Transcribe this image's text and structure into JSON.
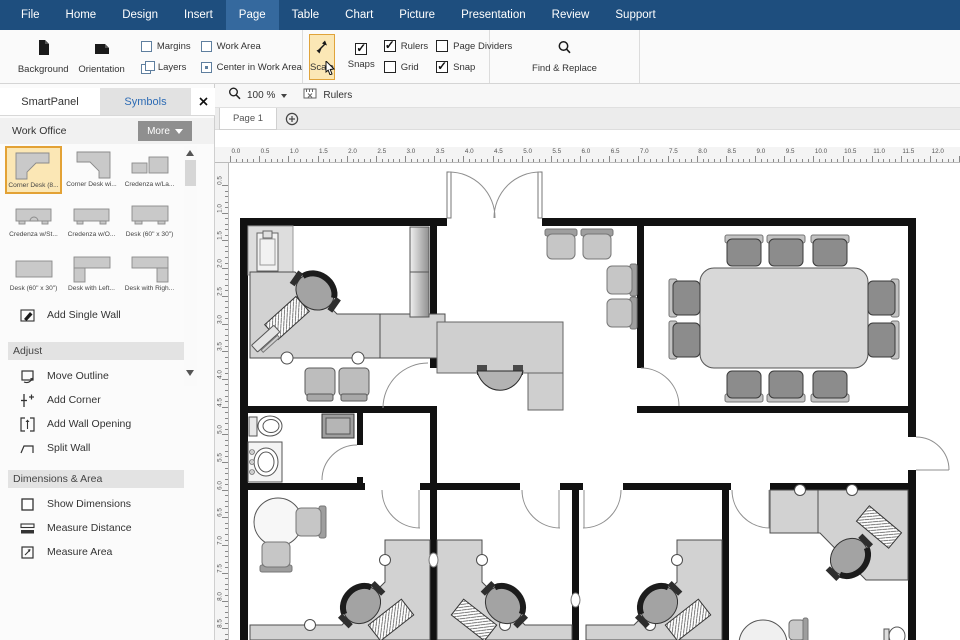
{
  "menu": {
    "items": [
      "File",
      "Home",
      "Design",
      "Insert",
      "Page",
      "Table",
      "Chart",
      "Picture",
      "Presentation",
      "Review",
      "Support"
    ],
    "active": "Page"
  },
  "ribbon": {
    "background_label": "Background",
    "orientation_label": "Orientation",
    "margins_label": "Margins",
    "layers_label": "Layers",
    "work_area_label": "Work Area",
    "center_label": "Center in Work Area",
    "scale_label": "Scale",
    "snaps_label": "Snaps",
    "rulers_label": "Rulers",
    "grid_label": "Grid",
    "page_dividers_label": "Page Dividers",
    "snap_label": "Snap",
    "find_replace_label": "Find & Replace",
    "checks": {
      "snaps": true,
      "rulers": true,
      "grid": false,
      "page_dividers": false,
      "snap": true
    }
  },
  "panel": {
    "tabs": [
      "SmartPanel",
      "Symbols"
    ],
    "active_tab": "Symbols",
    "library": "Work Office",
    "more_label": "More",
    "symbols": [
      "Corner Desk (8...",
      "Corner Desk wi...",
      "Credenza w/La...",
      "Credenza w/St...",
      "Credenza w/O...",
      "Desk (60\" x 30\")",
      "Desk (60\" x 30\")",
      "Desk with Left...",
      "Desk with Righ..."
    ],
    "selected_symbol": "Corner Desk (8...",
    "add_single_wall": "Add Single Wall",
    "adjust": {
      "title": "Adjust",
      "items": [
        "Move Outline",
        "Add Corner",
        "Add Wall Opening",
        "Split Wall"
      ]
    },
    "dimensions": {
      "title": "Dimensions & Area",
      "items": [
        "Show Dimensions",
        "Measure Distance",
        "Measure Area"
      ]
    }
  },
  "canvas": {
    "zoom_level": "100 %",
    "rulers_label": "Rulers",
    "page_tab": "Page 1",
    "h_ruler_labels": [
      "0.0",
      "0.5",
      "1.0",
      "1.5",
      "2.0",
      "2.5",
      "3.0",
      "3.5",
      "4.0",
      "4.5",
      "5.0",
      "5.5",
      "6.0",
      "6.5",
      "7.0",
      "7.5",
      "8.0",
      "8.5",
      "9.0",
      "9.5",
      "10.0",
      "10.5",
      "11.0",
      "11.5",
      "12.0",
      "12.5"
    ],
    "v_ruler_labels": [
      "0.5",
      "1.0",
      "1.5",
      "2.0",
      "2.5",
      "3.0",
      "3.5",
      "4.0",
      "4.5",
      "5.0",
      "5.5",
      "6.0",
      "6.5",
      "7.0",
      "7.5",
      "8.0",
      "8.5"
    ]
  },
  "colors": {
    "menubar": "#1e4e7e",
    "menu_active": "#35699e",
    "scale_highlight": "#fbe7b5",
    "scale_border": "#e0a33a",
    "symbol_selected_border": "#e3a235",
    "wall": "#111111",
    "furniture": "#d2d2d2",
    "active_tab_text": "#2e6cb5"
  }
}
